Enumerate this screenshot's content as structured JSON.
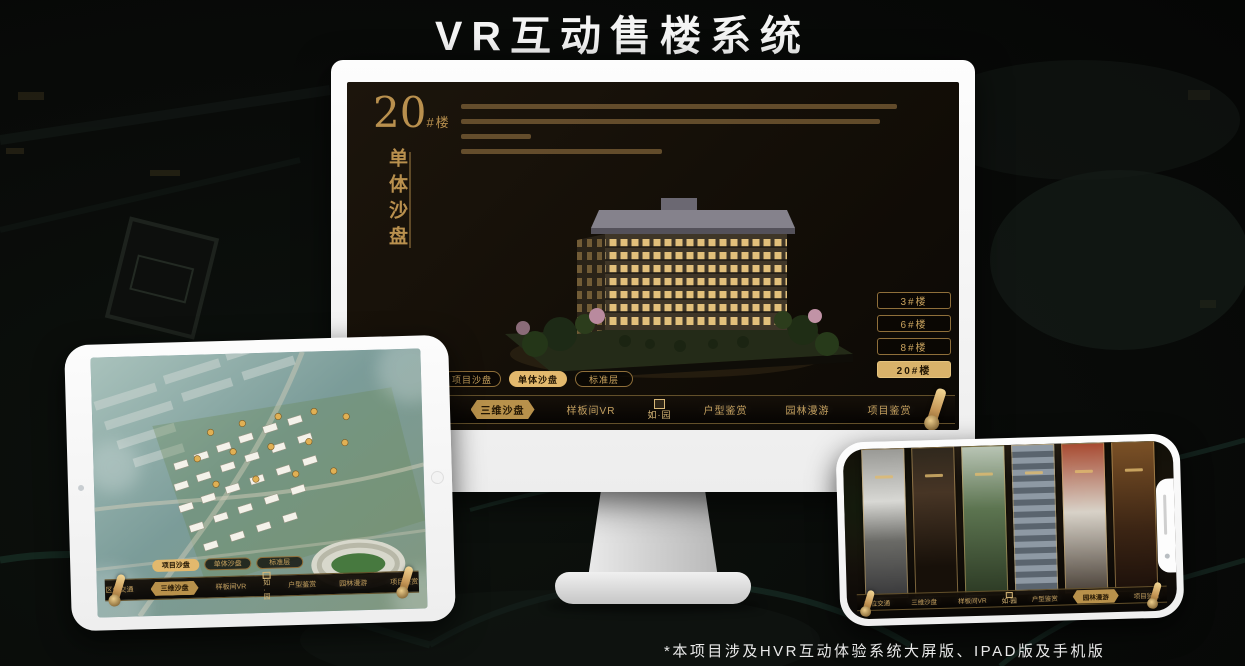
{
  "page_title": "VR互动售楼系统",
  "footnote": "*本项目涉及HVR互动体验系统大屏版、IPAD版及手机版",
  "colors": {
    "accent_gold": "#c9a35e",
    "gold_fill": "#d9b26a",
    "screen_bg": "#161007",
    "nav_bg": "#0c0905",
    "active_text": "#241704",
    "title_text": "#f4f4f4"
  },
  "nav": {
    "items": [
      "区位交通",
      "三维沙盘",
      "样板间VR",
      "户型鉴赏",
      "园林漫游",
      "项目鉴赏"
    ],
    "logo_text": "如·园",
    "logo_seal_icon": "seal-icon",
    "scroll_icon": "scroll-handle-icon"
  },
  "monitor": {
    "badge_number": "20",
    "badge_unit": "#楼",
    "badge_caption": "单体沙盘",
    "floor_buttons": [
      {
        "label": "3#楼"
      },
      {
        "label": "6#楼"
      },
      {
        "label": "8#楼"
      },
      {
        "label": "20#楼"
      }
    ],
    "active_floor": "20#楼",
    "mode_tabs": [
      {
        "label": "项目沙盘"
      },
      {
        "label": "单体沙盘"
      },
      {
        "label": "标准层"
      }
    ],
    "active_mode": "单体沙盘",
    "active_nav": "三维沙盘"
  },
  "tablet": {
    "mode_tabs": [
      {
        "label": "项目沙盘"
      },
      {
        "label": "单体沙盘"
      },
      {
        "label": "标准层"
      }
    ],
    "active_mode": "项目沙盘",
    "active_nav": "三维沙盘"
  },
  "phone": {
    "active_nav": "园林漫游",
    "gallery_panel_count": 6
  }
}
